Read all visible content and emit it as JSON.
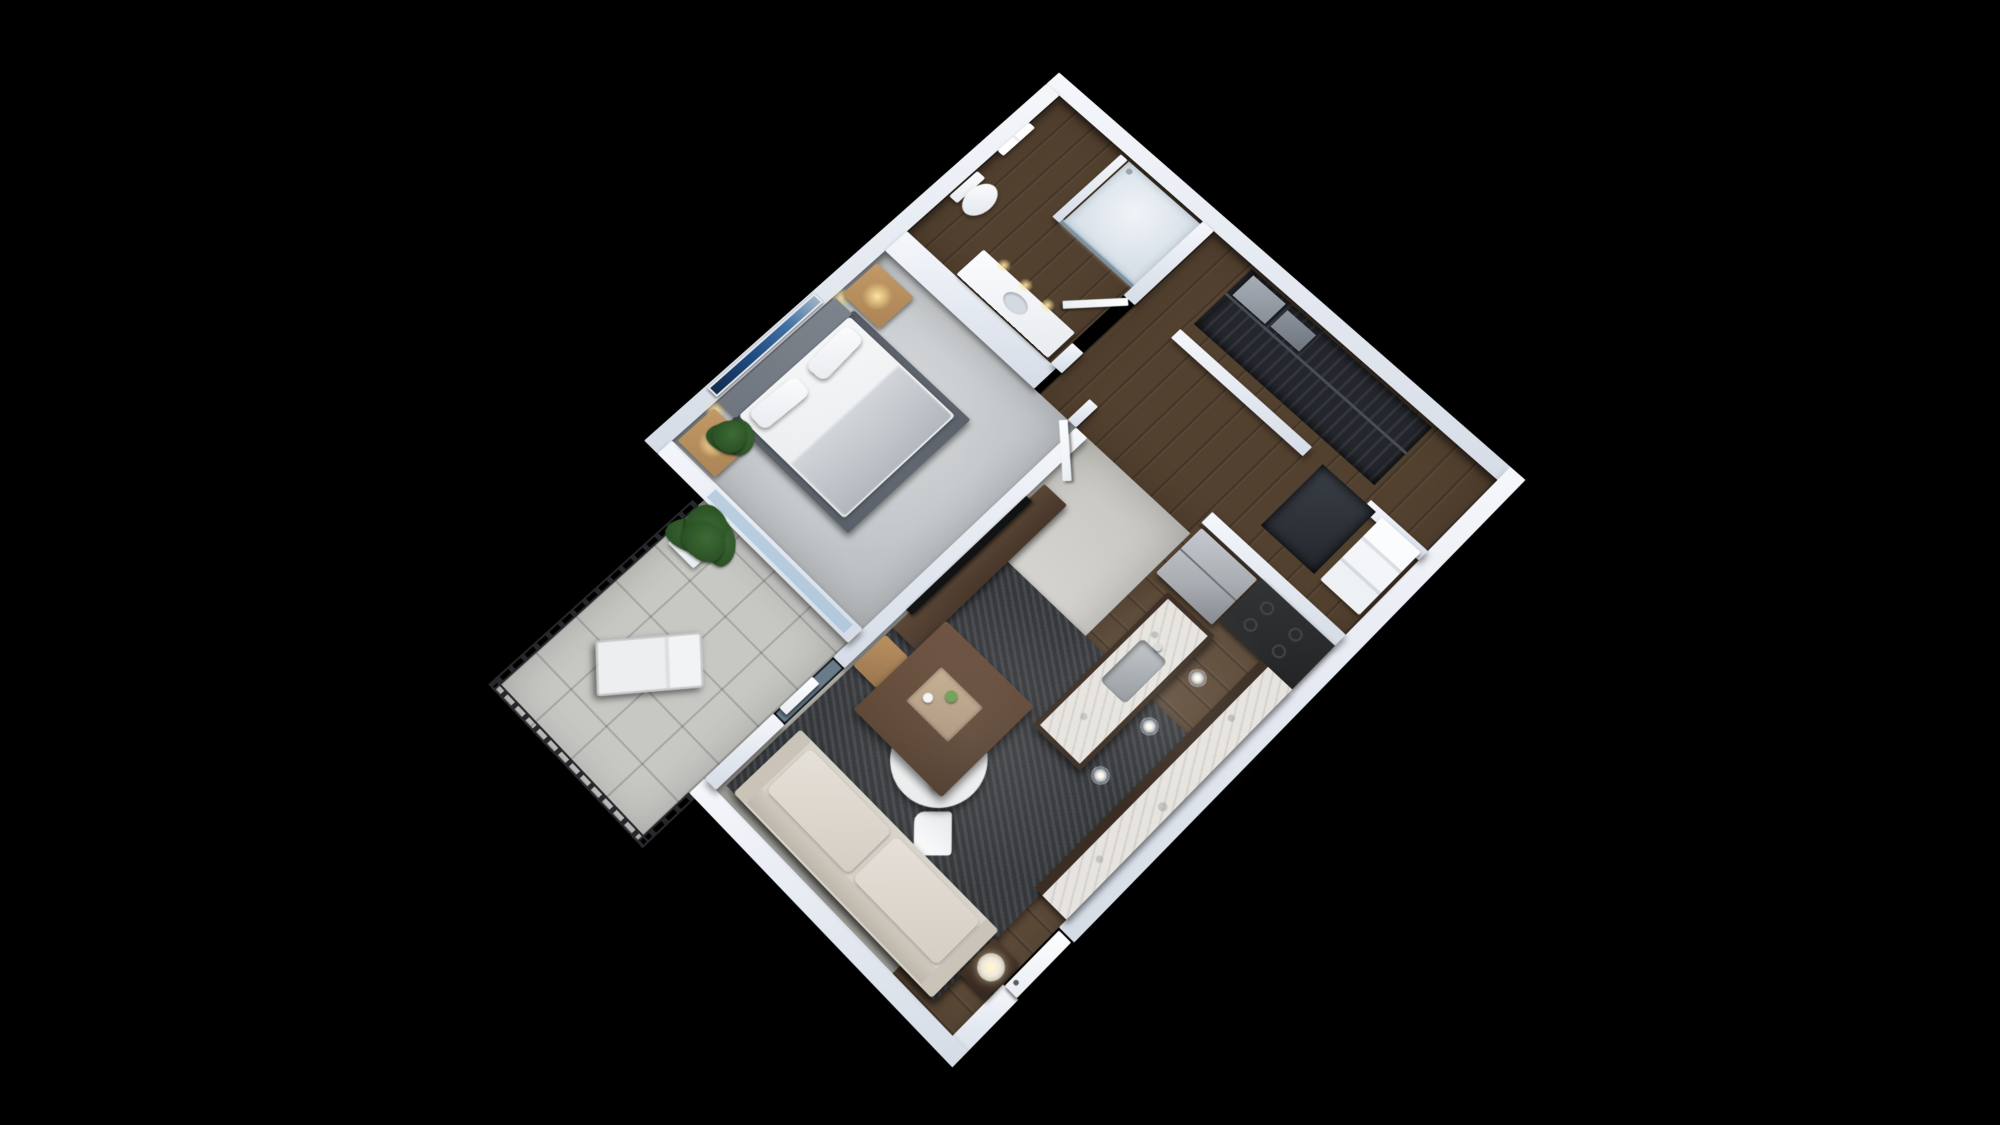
{
  "scene": {
    "type": "3d-floor-plan-render",
    "view": "isometric top-down, plan rotated 45 degrees",
    "background": "#000000",
    "unit_label": "one-bedroom apartment with balcony"
  },
  "palette": {
    "wall": "#e7ebf2",
    "carpet_bedroom": "#c7cbce",
    "carpet_living": "#cdccc6",
    "wood_bath_hall": "#53412f",
    "wood_kitchen": "#5e4b39",
    "closet_dark": "#23262c",
    "rug_charcoal": "#3c3f43",
    "cabinet_espresso": "#3b2d23",
    "marble": "#e7e4df",
    "stainless_steel": "#a8acb1",
    "sofa_cream": "#d8d3c9",
    "bed_linen": "#eceef0",
    "blanket_gray": "#c2c7cd",
    "headboard_gray": "#6e757e",
    "nightstand_wood": "#ab8355",
    "tv_console_walnut": "#47362a",
    "coffee_table_walnut": "#5b4331",
    "tv_black": "#101214",
    "painting_blue": "#1d4a7e",
    "plant_green": "#3c6b35",
    "balcony_tile": "#c7c7c3",
    "railing_black": "#26282c",
    "glass_blue": "#9ebdd4",
    "lamp_glow": "#ffe9aa",
    "door_white": "#f6f8fb"
  },
  "rooms": [
    {
      "id": "bedroom",
      "label": "Bedroom",
      "floor": "carpet"
    },
    {
      "id": "bathroom",
      "label": "Bathroom",
      "floor": "dark wood"
    },
    {
      "id": "closet",
      "label": "Walk-in closet",
      "floor": "dark wood"
    },
    {
      "id": "laundry",
      "label": "Laundry / storage nook",
      "floor": "dark wood"
    },
    {
      "id": "kitchen",
      "label": "Kitchen",
      "floor": "walnut wood"
    },
    {
      "id": "dining",
      "label": "Dining nook",
      "floor": "carpet"
    },
    {
      "id": "living",
      "label": "Living room",
      "floor": "carpet"
    },
    {
      "id": "entry",
      "label": "Entry",
      "floor": "walnut wood"
    },
    {
      "id": "balcony",
      "label": "Balcony",
      "floor": "stone tile"
    }
  ],
  "furniture": {
    "bedroom": [
      "queen bed with gray headboard and white linens",
      "two wood nightstands with lit lamps",
      "blue abstract seascape painting",
      "two wall sconces",
      "TV wall with walnut console and flat TV",
      "small dresser",
      "potted plant",
      "window wall to balcony"
    ],
    "bathroom": [
      "glass shower stall",
      "toilet",
      "double towel rack",
      "vanity with three round bulbs",
      "swing door"
    ],
    "closet": [
      "hanging clothes rod",
      "two storage boxes on shelf"
    ],
    "laundry": [
      "stacked washer unit",
      "open storage closet"
    ],
    "kitchen": [
      "stainless refrigerator",
      "dark cooktop counter",
      "espresso cabinets with marble counter",
      "island with undermount sink and faucet",
      "three glass pendant lights"
    ],
    "dining": [
      "round white table with two place settings",
      "two white molded chairs"
    ],
    "living": [
      "charcoal area rug",
      "walnut coffee table with tray, vase and cup",
      "cream three-seat sofa",
      "side table with drum lamp"
    ],
    "entry": [
      "white entry door"
    ],
    "balcony": [
      "black metal railing",
      "potted palm",
      "white lounge chair",
      "sliding glass door"
    ]
  }
}
